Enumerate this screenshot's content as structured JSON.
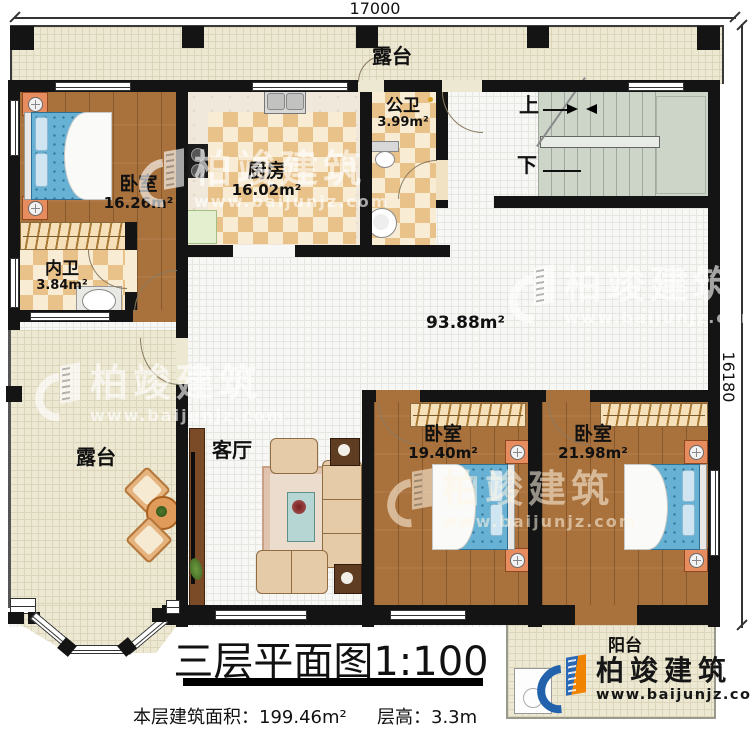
{
  "dimensions": {
    "top_width": "17000",
    "right_height": "16180"
  },
  "rooms": {
    "terrace_top": {
      "label": "露台"
    },
    "bedroom_nw": {
      "label": "卧室",
      "area": "16.26m²"
    },
    "kitchen": {
      "label": "厨房",
      "area": "16.02m²"
    },
    "bath_public": {
      "label": "公卫",
      "area": "3.99m²"
    },
    "bath_inner": {
      "label": "内卫",
      "area": "3.84m²"
    },
    "stairs": {
      "up": "上",
      "down": "下"
    },
    "hall": {
      "area": "93.88m²"
    },
    "terrace_left": {
      "label": "露台"
    },
    "living_room": {
      "label": "客厅"
    },
    "bedroom_s_left": {
      "label": "卧室",
      "area": "19.40m²"
    },
    "bedroom_s_right": {
      "label": "卧室",
      "area": "21.98m²"
    },
    "balcony": {
      "label": "阳台"
    }
  },
  "title": {
    "text": "三层平面图",
    "scale": "1:100"
  },
  "stats": {
    "floor_area": "本层建筑面积：199.46m²",
    "floor_height": "层高：3.3m"
  },
  "brand": {
    "name": "柏竣建筑",
    "website": "www.baijunjz.com"
  },
  "watermark": {
    "name": "柏竣建筑",
    "website": "www.baijunjz.com"
  },
  "colors": {
    "wall": "#141414",
    "wood": "#a9713c",
    "tile": "#f7f7f5",
    "beige": "#ece8d2",
    "checker": "#e9c28a",
    "stair": "#cdd5c9",
    "bed": "#66b1d4",
    "accent_blue": "#2261ac",
    "accent_orange": "#f08300"
  }
}
